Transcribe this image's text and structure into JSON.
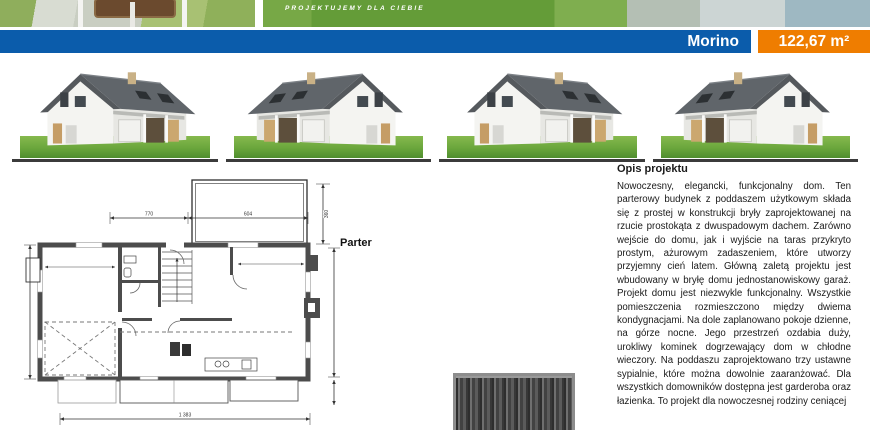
{
  "top_photos": {
    "tagline": "PROJEKTUJEMY DLA CIEBIE"
  },
  "title_bar": {
    "title": "Morino",
    "area": "122,67 m²",
    "blue": "#0b5cab",
    "orange": "#ef7d00"
  },
  "floor_plan": {
    "label": "Parter",
    "dim_top_left": "770",
    "dim_top_right": "604",
    "dim_canopy_side": "360",
    "dim_bottom": "1 383"
  },
  "description": {
    "heading": "Opis projektu",
    "body": "Nowoczesny, elegancki, funkcjonalny dom. Ten parterowy budynek z poddaszem użytkowym składa się z prostej w konstrukcji bryły zaprojektowanej na rzucie prostokąta z dwuspadowym dachem. Zarówno wejście do domu, jak i wyjście na taras przykryto prostym, ażurowym zadaszeniem, które utworzy przyjemny cień latem. Główną zaletą projektu jest wbudowany w bryłę domu jednostanowiskowy garaż. Projekt domu jest niezwykle funkcjonalny. Wszystkie pomieszczenia rozmieszczono między dwiema kondygnacjami. Na dole zaplanowano pokoje dzienne, na górze nocne. Jego przestrzeń ozdabia duży, urokliwy kominek dogrzewający dom w chłodne wieczory. Na poddaszu zaprojektowano trzy ustawne sypialnie, które można dowolnie zaaranżować. Dla wszystkich domowników dostępna jest garderoba oraz łazienka. To projekt dla nowoczesnej rodziny ceniącej"
  }
}
